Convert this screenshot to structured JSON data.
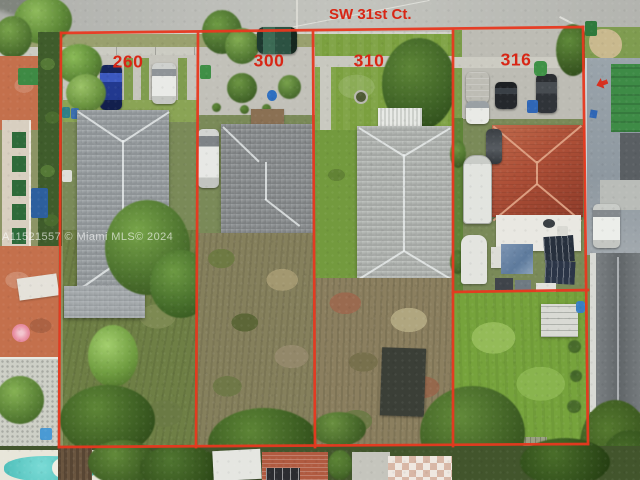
{
  "annotation": {
    "color": "#e8381f",
    "label_color": "#d82615",
    "street_label": "SW 31st Ct.",
    "lots": [
      {
        "number": "260"
      },
      {
        "number": "300"
      },
      {
        "number": "310"
      },
      {
        "number": "316"
      }
    ]
  },
  "watermark": {
    "text": "A11521557 © Miami MLS© 2024"
  }
}
